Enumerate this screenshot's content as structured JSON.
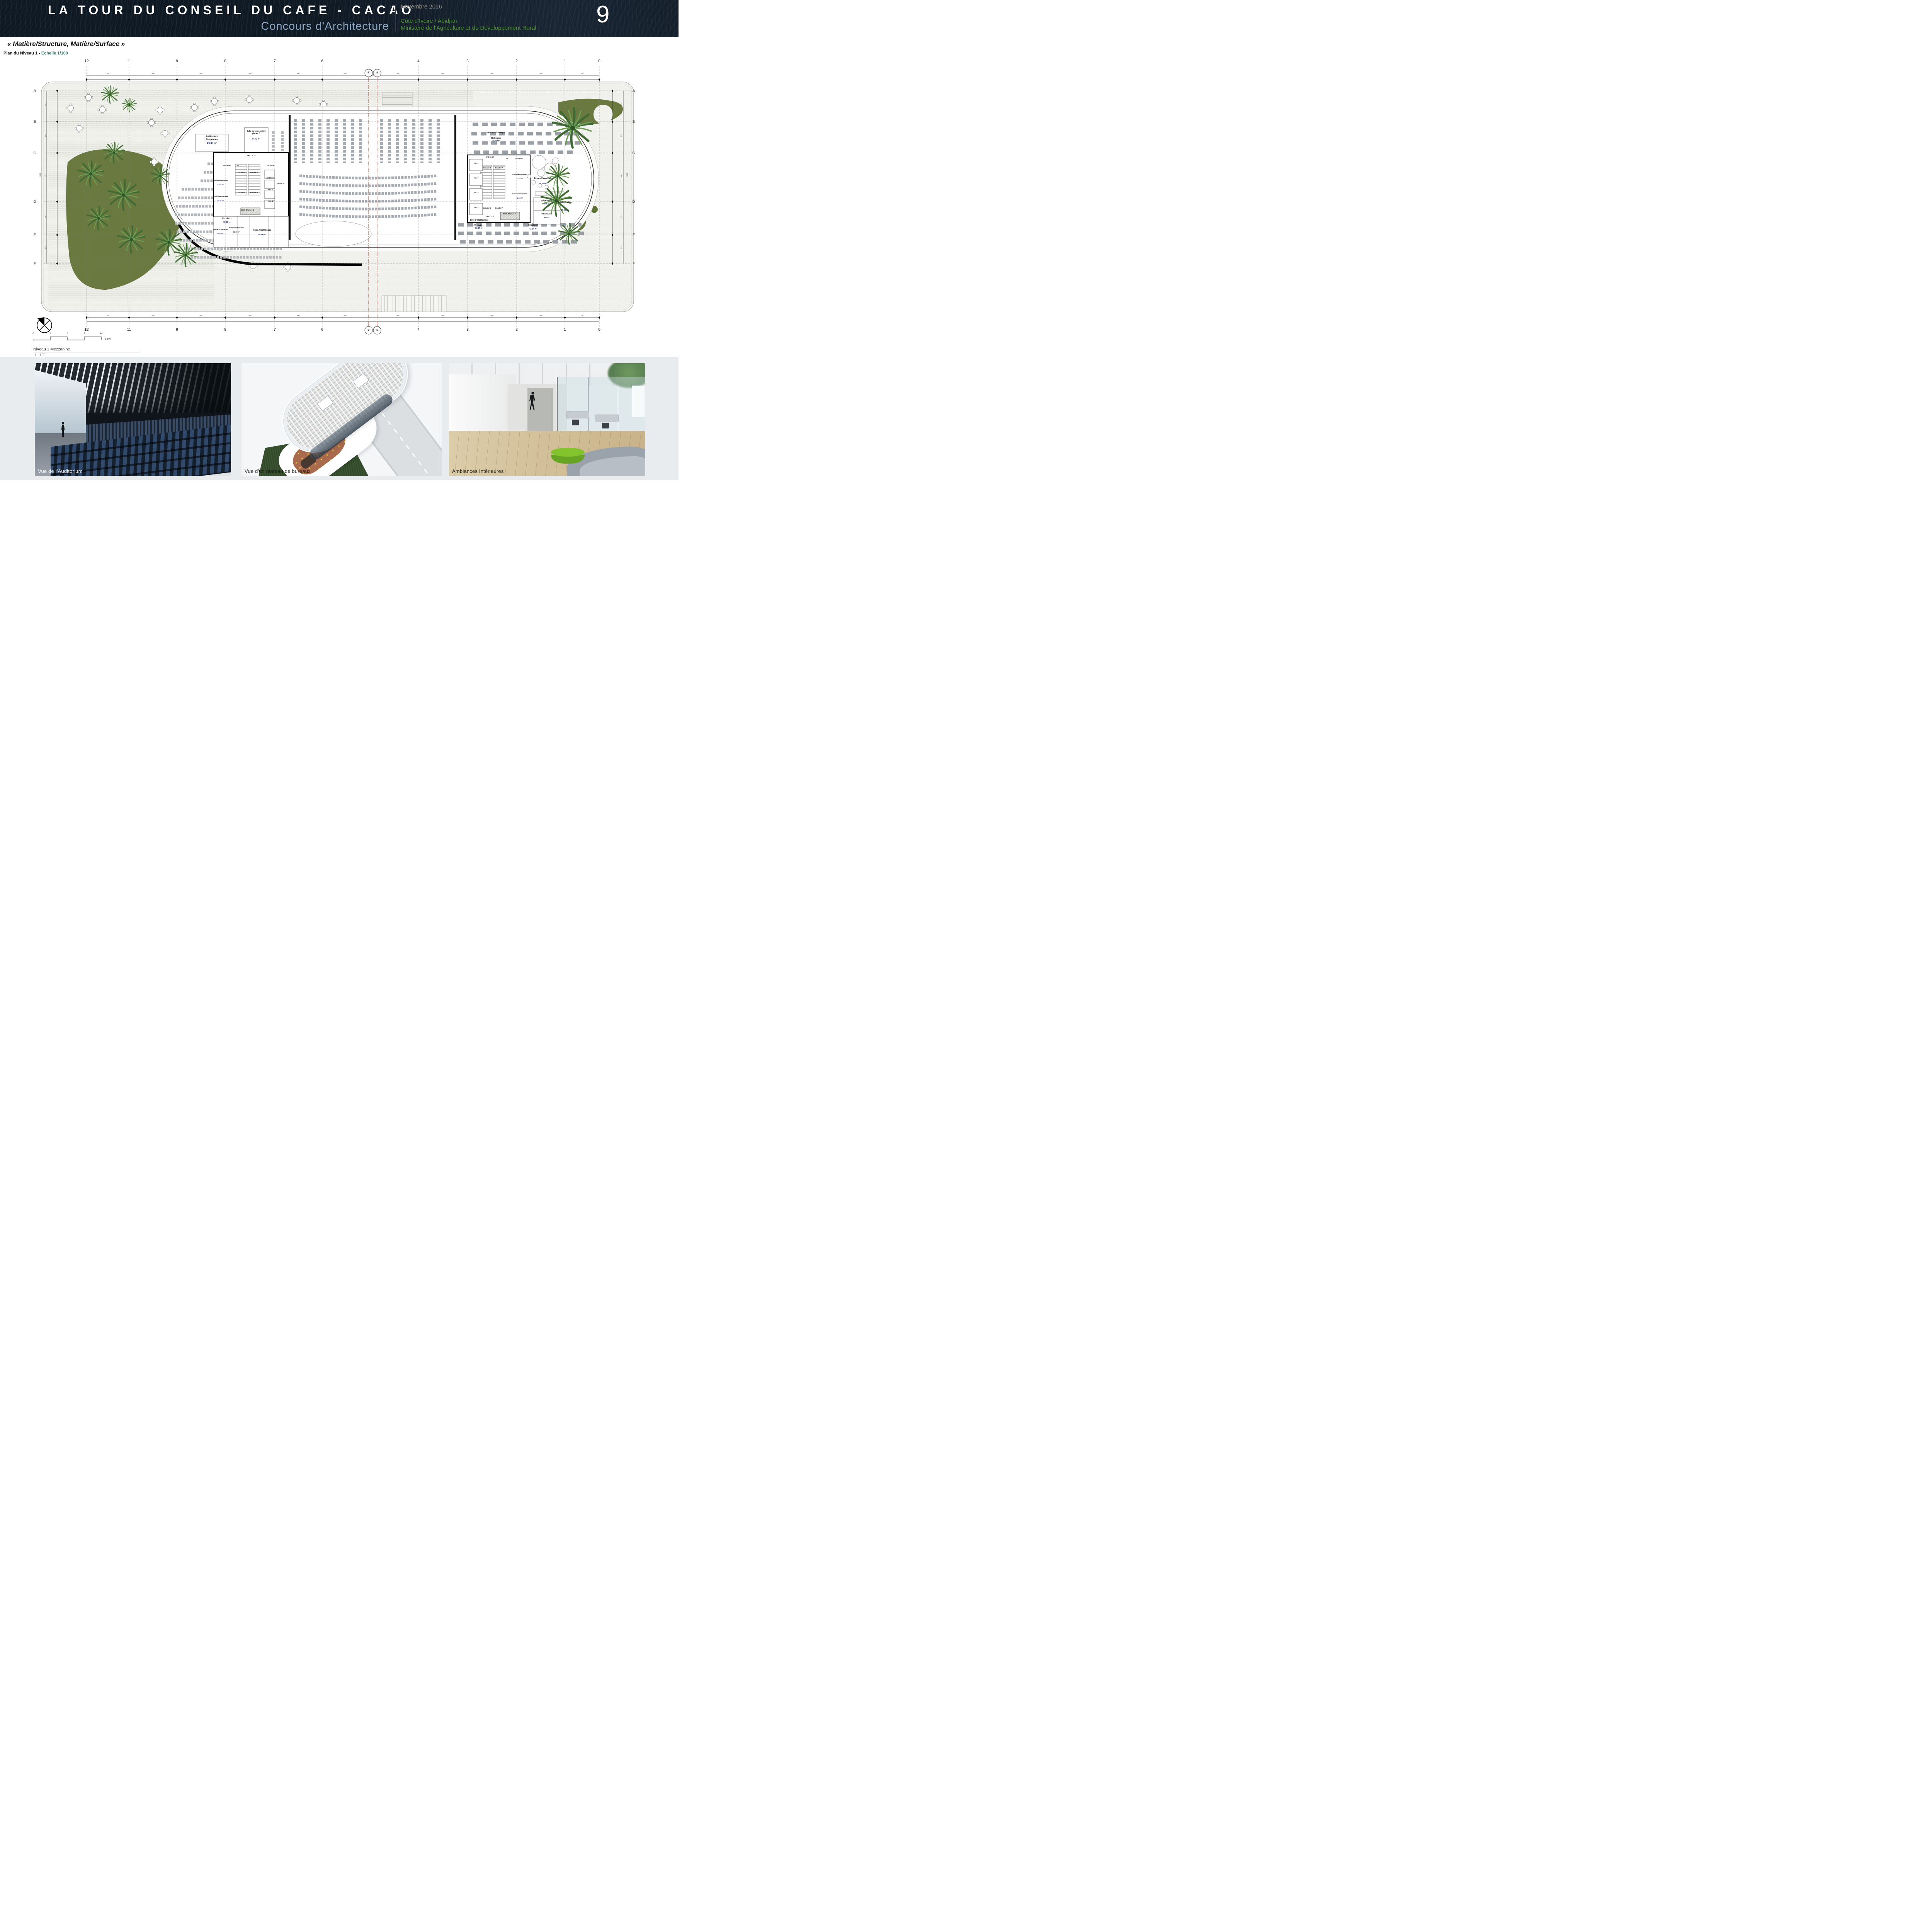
{
  "header": {
    "title": "LA TOUR DU CONSEIL DU CAFE - CACAO",
    "subtitle": "Concours d'Architecture",
    "date": "Novembre 2016",
    "location": "Côte d'Ivoire / Abidjan",
    "ministry": "Ministère de l'Agriculture et du Développement Rural",
    "page_number": "9",
    "colors": {
      "background": "#0f1924",
      "subtitle": "#8ba6c3",
      "accent_green": "#4e8f33"
    }
  },
  "board": {
    "section_title": "« Matière/Structure, Matière/Surface  »",
    "plan_label": "Plan du Niveau 1 - ",
    "scale_label": "Echelle 1/100"
  },
  "plan": {
    "grid": {
      "cols": [
        "12",
        "11",
        "9",
        "8",
        "7",
        "6",
        "4",
        "3",
        "2",
        "1",
        "0"
      ],
      "section_bubbles": [
        "5'",
        "5"
      ],
      "rows": [
        "A",
        "B",
        "C",
        "D",
        "E",
        "F"
      ],
      "dims_h": [
        "750",
        "850",
        "850",
        "850",
        "850",
        "850",
        "850",
        "850",
        "850",
        "850",
        "750"
      ],
      "dims_v": [
        "525",
        "575",
        "840",
        "575",
        "525"
      ],
      "dims_v_total": "3040"
    },
    "rooms": {
      "auditorium_name": "Auditorium",
      "auditorium_places": "200 places",
      "auditorium_area": "143.17 m²",
      "reunion_name": "Salle de réunion 100 places B",
      "reunion_area": "84.72 m²",
      "entretient": "Entretient",
      "lt": "LT",
      "sas_cf": "SAS CF. 2h",
      "asc_prive": "Asc. Privé",
      "sas_prive": "SAS Privé",
      "asc1": "Asc. 1",
      "asc2": "Asc. 2",
      "asc3": "Asc. 3",
      "asc4": "Asc. 4",
      "asc5": "Asc. 5",
      "asc6": "Asc. 6",
      "escalier_a": "Escalier A",
      "escalier_b": "Escalier B",
      "san_h_name": "Sanitaires Hommes",
      "san_h_area": "12.67 m²",
      "san_f_name": "Sanitaires Femmes",
      "san_f_area": "12.61 m²",
      "san_h2_area": "10.47 m²",
      "san_f2_area": "13.09 m²",
      "circulation": "Circulation",
      "circulation1_area": "35.25 m²",
      "circulation2_area": "43.94 m²",
      "regie_name": "Régie Amphithéatre",
      "regie_area": "19.14 m²",
      "monte_a": "Monte Charges A",
      "monte_b": "Monte Charges B",
      "pause_name": "Espace Pause-café",
      "pause_area": "39.49 m²",
      "office_name": "Office traiteur",
      "office1_area": "5.85 m²",
      "office2_area": "6.60 m²",
      "cuisine_name": "Cuisine traiteur",
      "cuisine_area": "25.70 m²",
      "info_name": "Salle d'informatique",
      "info_sub": "33 desktop",
      "info_area": "91.97 m²"
    },
    "scalebar": {
      "ticks": [
        "0",
        "1",
        "2",
        "3",
        "4m"
      ],
      "ratio": "1:100"
    },
    "drawing_name": "Niveau 1 Mezzanine",
    "drawing_scale": "1 : 100"
  },
  "photos": [
    {
      "caption": "Vue de l'Auditorium"
    },
    {
      "caption": "Vue d'un plateau de bureaux"
    },
    {
      "caption": "Ambiances Intérieures"
    }
  ]
}
